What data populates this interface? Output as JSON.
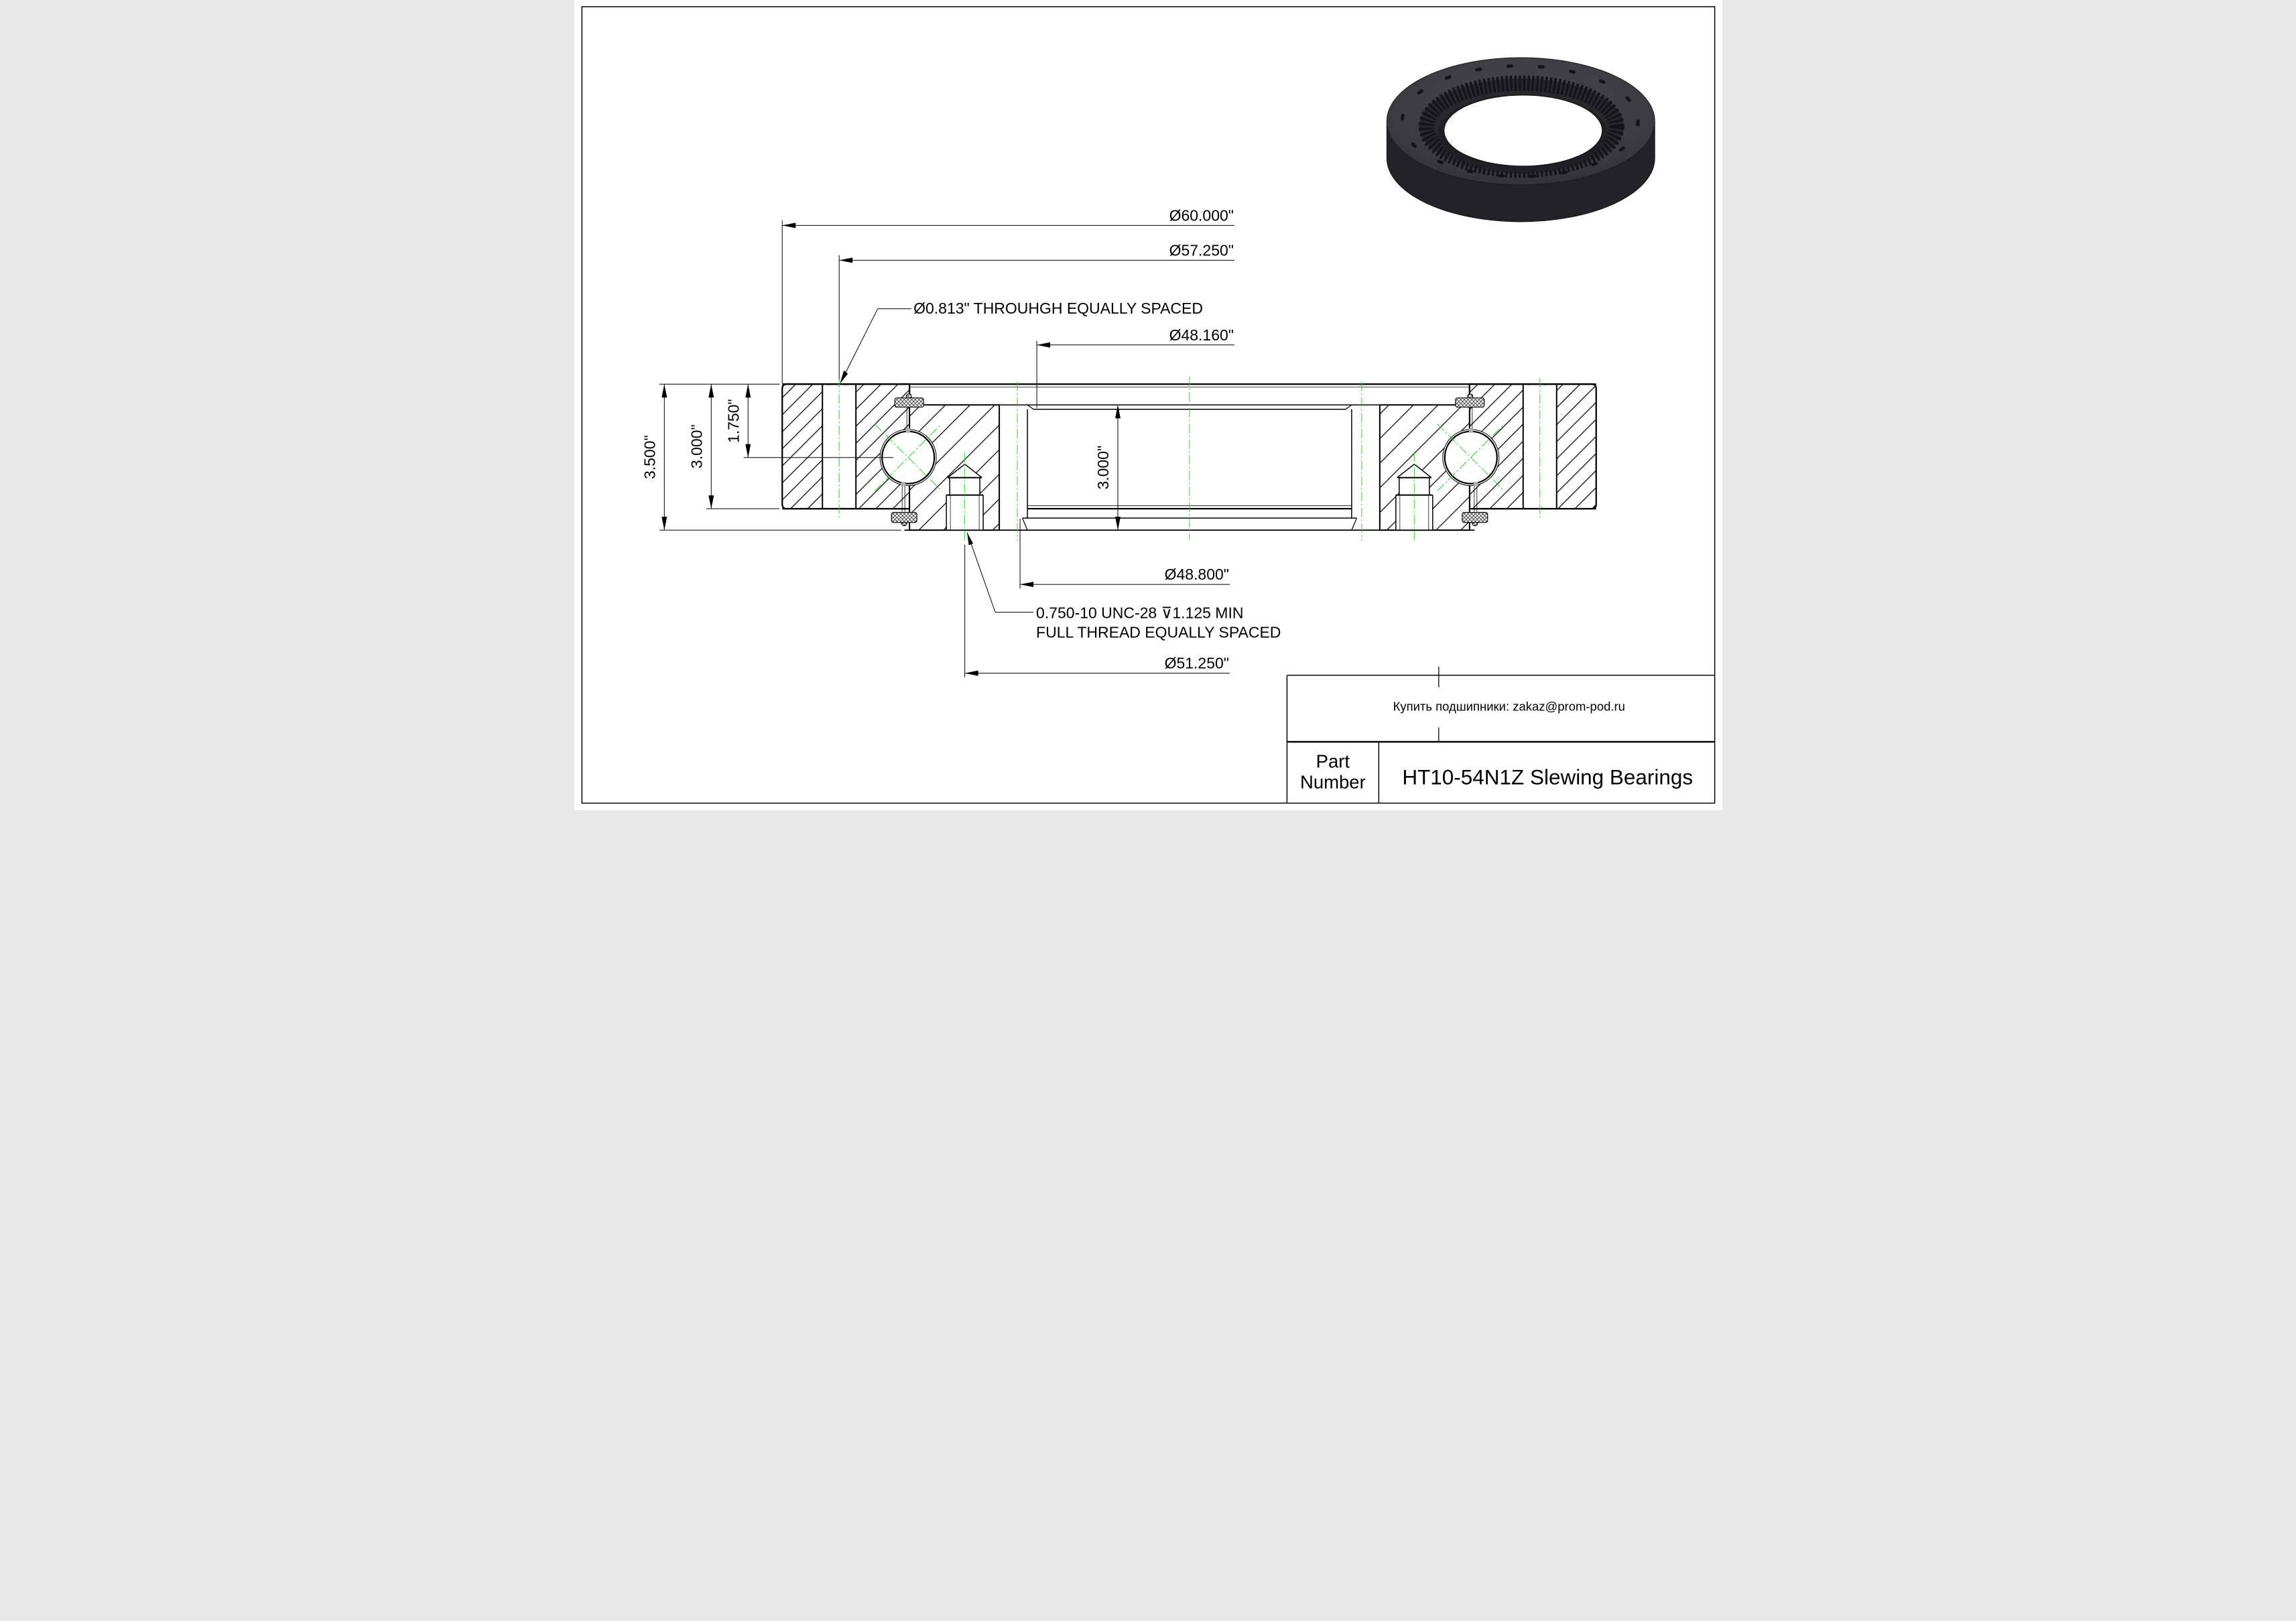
{
  "colors": {
    "paper": "#ffffff",
    "line": "#000000",
    "centerline_green": "#33cc33",
    "bearing_body": "#3b3b3e",
    "bearing_dark": "#232325"
  },
  "dimensions": {
    "outer_diameter": "Ø60.000\"",
    "outer_bolt_circle": "Ø57.250\"",
    "outer_hole_note": "Ø0.813\" THROUHGH EQUALLY SPACED",
    "bore_top_diameter": "Ø48.160\"",
    "total_height": "3.500\"",
    "outer_ring_height": "3.000\"",
    "ball_center_depth": "1.750\"",
    "inner_ring_height": "3.000\"",
    "bore_bottom_diameter": "Ø48.800\"",
    "thread_note_line1": "0.750-10 UNC-28 ⊽1.125 MIN",
    "thread_note_line2": "FULL THREAD EQUALLY SPACED",
    "inner_bolt_circle": "Ø51.250\""
  },
  "title_block": {
    "contact_note": "Купить подшипники: zakaz@prom-pod.ru",
    "part_label_line1": "Part",
    "part_label_line2": "Number",
    "part_value": "HT10-54N1Z Slewing  Bearings"
  }
}
